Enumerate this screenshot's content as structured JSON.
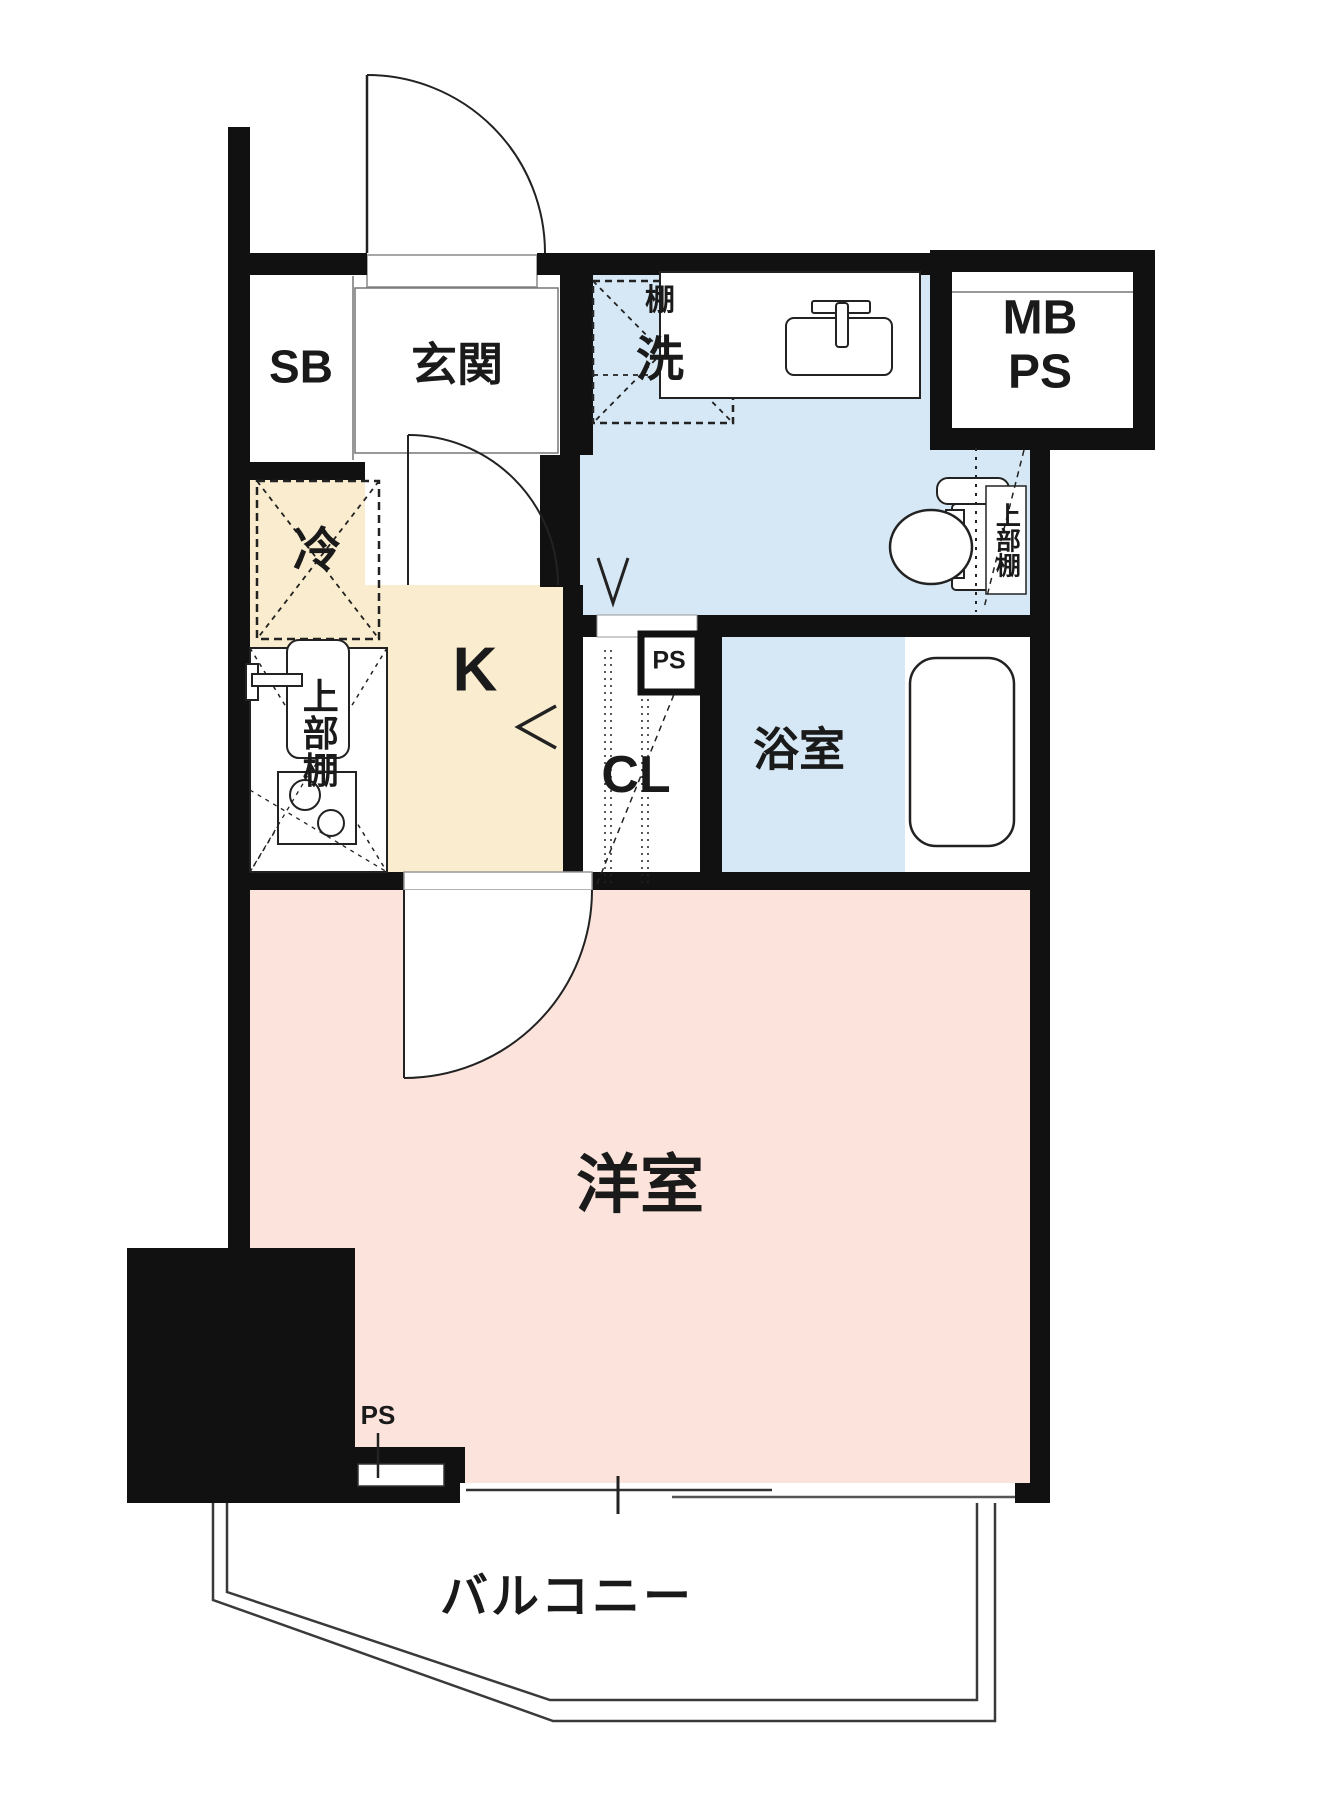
{
  "colors": {
    "wall": "#111111",
    "wet_area": "#d6e8f5",
    "kitchen_floor": "#faecce",
    "living_floor": "#fce4dc",
    "outline": "#3a3a3a"
  },
  "rooms": {
    "shoe_box": {
      "label": "SB"
    },
    "entrance": {
      "label": "玄関"
    },
    "laundry": {
      "shelf": "棚",
      "washer": "洗"
    },
    "meter_pipe_space": {
      "line1": "MB",
      "line2": "PS"
    },
    "refrigerator": {
      "label": "冷"
    },
    "kitchen": {
      "label": "K",
      "upper_shelf": "上部棚"
    },
    "closet": {
      "label": "CL"
    },
    "pipe_space_upper": {
      "label": "PS"
    },
    "bathroom": {
      "label": "浴室"
    },
    "toilet": {
      "upper_shelf": "上部棚"
    },
    "western_room": {
      "label": "洋室"
    },
    "pipe_space_lower": {
      "label": "PS"
    },
    "balcony": {
      "label": "バルコニー"
    }
  }
}
